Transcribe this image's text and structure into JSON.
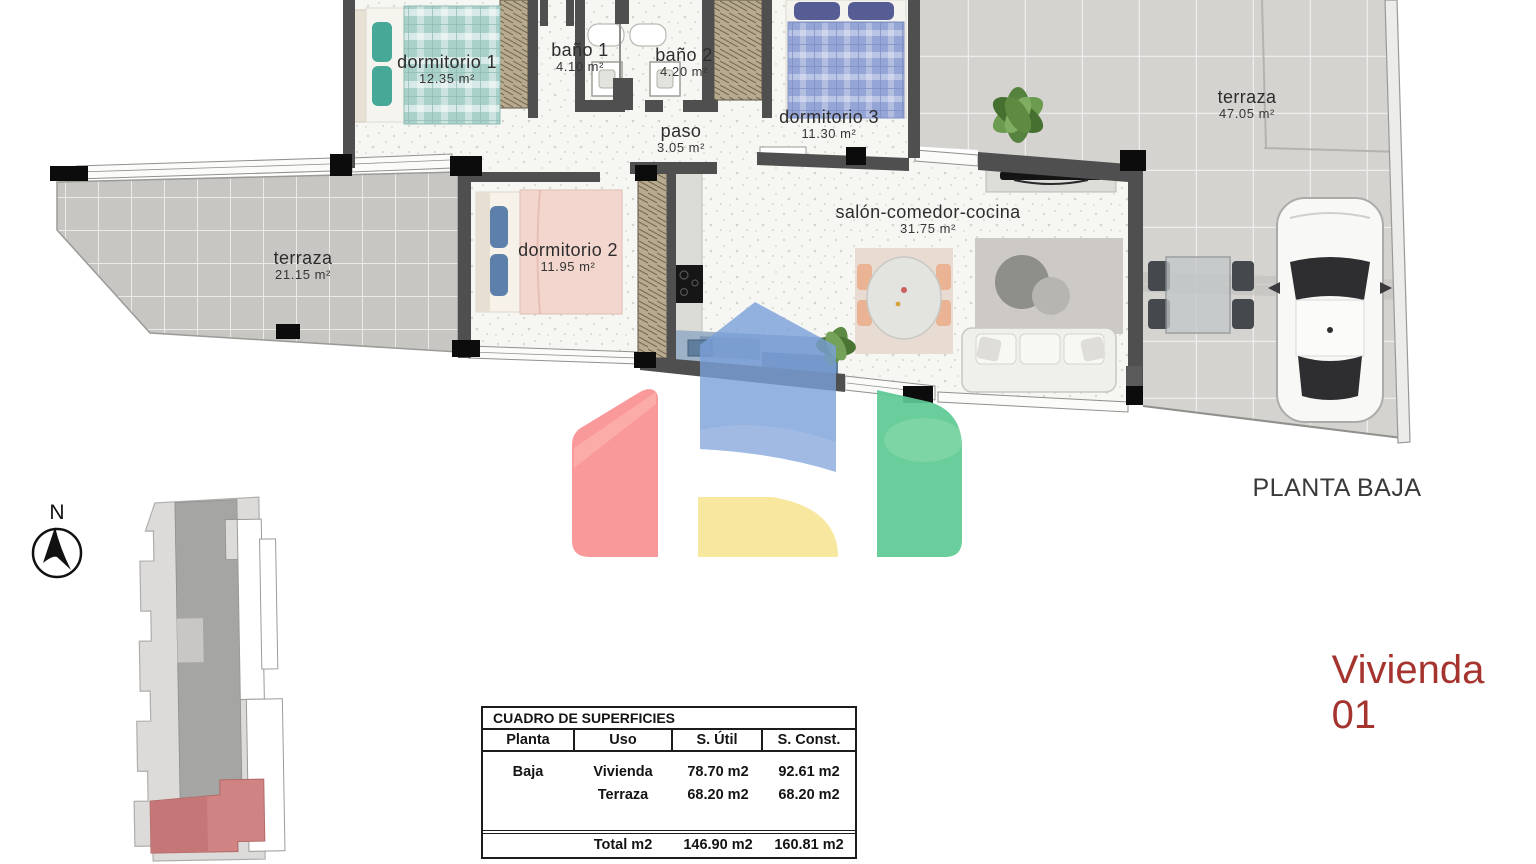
{
  "header": {
    "floor_label": "PLANTA BAJA",
    "unit_label": "Vivienda 01",
    "compass_label": "N"
  },
  "rooms": [
    {
      "id": "dormitorio-1",
      "name": "dormitorio 1",
      "area": "12.35",
      "unit": "m²"
    },
    {
      "id": "bano-1",
      "name": "baño 1",
      "area": "4.10",
      "unit": "m²"
    },
    {
      "id": "bano-2",
      "name": "baño 2",
      "area": "4.20",
      "unit": "m²"
    },
    {
      "id": "paso",
      "name": "paso",
      "area": "3.05",
      "unit": "m²"
    },
    {
      "id": "dormitorio-3",
      "name": "dormitorio 3",
      "area": "11.30",
      "unit": "m²"
    },
    {
      "id": "dormitorio-2",
      "name": "dormitorio 2",
      "area": "11.95",
      "unit": "m²"
    },
    {
      "id": "salon",
      "name": "salón-comedor-cocina",
      "area": "31.75",
      "unit": "m²"
    },
    {
      "id": "terraza-izquierda",
      "name": "terraza",
      "area": "21.15",
      "unit": "m²"
    },
    {
      "id": "terraza-derecha",
      "name": "terraza",
      "area": "47.05",
      "unit": "m²"
    }
  ],
  "surface_table": {
    "title": "CUADRO DE SUPERFICIES",
    "columns": [
      "Planta",
      "Uso",
      "S. Útil",
      "S. Const."
    ],
    "rows": [
      {
        "planta": "Baja",
        "uso": "Vivienda",
        "s_util": "78.70 m2",
        "s_const": "92.61 m2"
      },
      {
        "planta": "",
        "uso": "Terraza",
        "s_util": "68.20 m2",
        "s_const": "68.20 m2"
      }
    ],
    "total": {
      "uso": "Total m2",
      "s_util": "146.90 m2",
      "s_const": "160.81 m2"
    }
  },
  "colors": {
    "accent_red": "#a5342f",
    "wall": "#4f4f4f",
    "logo_red": "#f89090",
    "logo_blue": "#7ba0d8",
    "logo_yellow": "#f8e69a",
    "logo_green": "#5fca94",
    "site_highlight": "#cf8383"
  }
}
